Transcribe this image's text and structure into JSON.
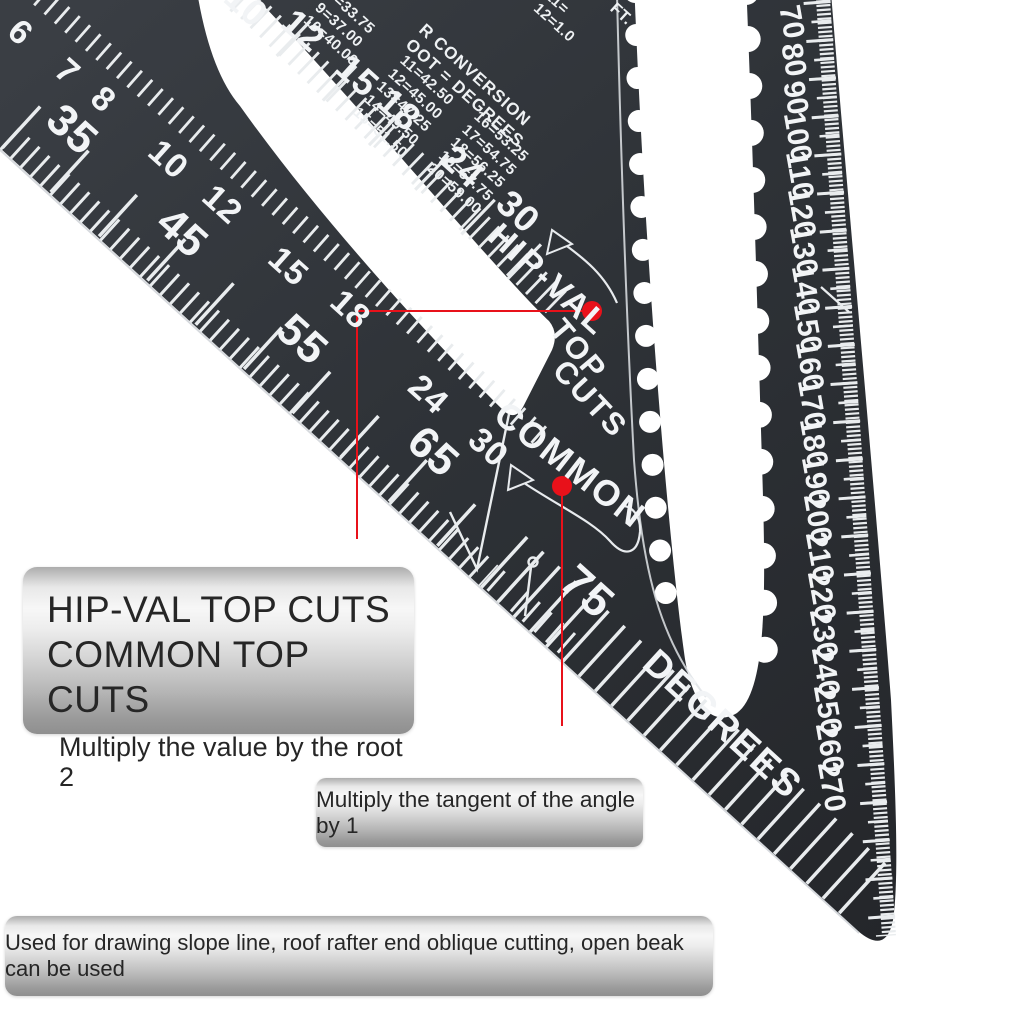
{
  "photo": {
    "background": "#ffffff"
  },
  "square": {
    "material_color": "#2e3237",
    "marking_color": "#f2f4f6",
    "scales": {
      "leg_row_a": {
        "values": [
          "6",
          "7",
          "8",
          "10",
          "12",
          "15",
          "18",
          "24",
          "30"
        ]
      },
      "leg_row_b": {
        "values": [
          "35",
          "45",
          "55",
          "65",
          "75"
        ]
      },
      "body_row": {
        "values": [
          "10",
          "12",
          "15",
          "18",
          "24",
          "30"
        ]
      },
      "hyp_mm": {
        "values": [
          "70",
          "80",
          "90",
          "100",
          "110",
          "120",
          "130",
          "140",
          "150",
          "160",
          "170",
          "180",
          "190",
          "200",
          "210",
          "220",
          "230",
          "240",
          "250",
          "260",
          "270"
        ]
      },
      "labels": {
        "hip_val": "HIP-VAL",
        "top": "TOP",
        "cuts": "CUTS",
        "common": "COMMON",
        "degrees": "DEGREES",
        "pivot_pitch": "75"
      }
    },
    "conversion_table": {
      "heading_line1": "R CONVERSION",
      "heading_line2": "OOT = DEGREES",
      "left_fragment": [
        "8=33.75",
        "9=37.00",
        "10=40.00"
      ],
      "col_a": [
        "11=42.50",
        "12=45.00",
        "13=47.25",
        "14=49.50",
        "15=51.50"
      ],
      "col_b": [
        "16=53.25",
        "17=54.75",
        "18=56.25",
        "19=57.75",
        "20=59.00"
      ],
      "corner_fragment": [
        "10=",
        "11=",
        "12=1.0"
      ],
      "corner_unit": "FT."
    }
  },
  "annotations": {
    "marker_color": "#e8111a",
    "callout1": {
      "line1": "HIP-VAL TOP CUTS",
      "line2": "COMMON TOP CUTS",
      "line3": "Multiply the value by the root 2"
    },
    "callout2": {
      "text": "Multiply the tangent of the angle by 1"
    },
    "callout3": {
      "text": "Used for drawing slope line, roof rafter end oblique cutting, open beak can be used"
    }
  }
}
